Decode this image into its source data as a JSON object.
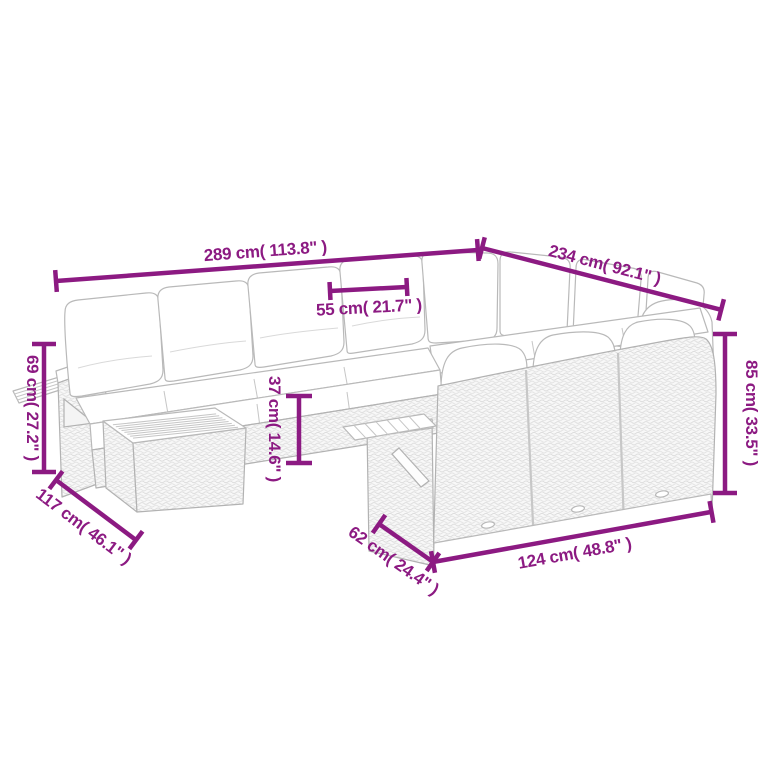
{
  "diagram": {
    "type": "product-dimension-diagram",
    "subject": "modular-rattan-garden-sofa-set-line-art",
    "background_color": "#ffffff",
    "accent_color": "#8C1A82",
    "line_art_color": "#b9b9b9",
    "dimensions": [
      {
        "id": "overall-width",
        "cm": 289,
        "inch": 113.8,
        "label": "289 cm( 113.8\" )"
      },
      {
        "id": "overall-depth",
        "cm": 234,
        "inch": 92.1,
        "label": "234 cm( 92.1\" )"
      },
      {
        "id": "seat-width",
        "cm": 55,
        "inch": 21.7,
        "label": "55 cm( 21.7\" )"
      },
      {
        "id": "arm-height",
        "cm": 69,
        "inch": 27.2,
        "label": "69 cm( 27.2\" )"
      },
      {
        "id": "side-depth",
        "cm": 117,
        "inch": 46.1,
        "label": "117 cm( 46.1\" )"
      },
      {
        "id": "seat-height",
        "cm": 37,
        "inch": 14.6,
        "label": "37 cm( 14.6\" )"
      },
      {
        "id": "back-height",
        "cm": 85,
        "inch": 33.5,
        "label": "85 cm( 33.5\" )"
      },
      {
        "id": "module-depth",
        "cm": 62,
        "inch": 24.4,
        "label": "62 cm( 24.4\" )"
      },
      {
        "id": "section-width",
        "cm": 124,
        "inch": 48.8,
        "label": "124 cm( 48.8\" )"
      }
    ]
  }
}
